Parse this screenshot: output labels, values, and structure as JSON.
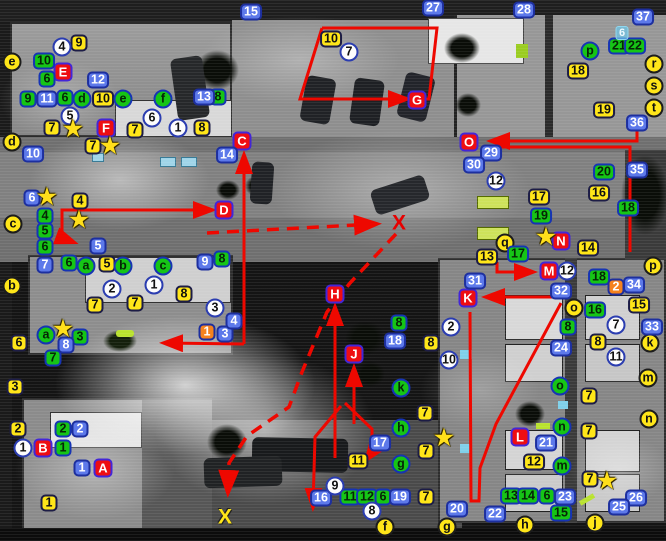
{
  "colors": {
    "route": "#ee0800",
    "site_red": "#ee0d12",
    "attacker_blue": "#5d79ea",
    "defender_green": "#16c516",
    "note_yellow": "#ffe619",
    "orange": "#f5821e"
  },
  "markers": [
    {
      "t": "red",
      "l": "A",
      "x": 103,
      "y": 468
    },
    {
      "t": "red",
      "l": "B",
      "x": 43,
      "y": 448
    },
    {
      "t": "red",
      "l": "C",
      "x": 242,
      "y": 141
    },
    {
      "t": "red",
      "l": "D",
      "x": 224,
      "y": 210
    },
    {
      "t": "red",
      "l": "E",
      "x": 63,
      "y": 72
    },
    {
      "t": "red",
      "l": "F",
      "x": 106,
      "y": 128
    },
    {
      "t": "red",
      "l": "G",
      "x": 417,
      "y": 100
    },
    {
      "t": "red",
      "l": "H",
      "x": 335,
      "y": 294
    },
    {
      "t": "red",
      "l": "J",
      "x": 354,
      "y": 354
    },
    {
      "t": "red",
      "l": "K",
      "x": 468,
      "y": 298
    },
    {
      "t": "red",
      "l": "L",
      "x": 520,
      "y": 437
    },
    {
      "t": "red",
      "l": "M",
      "x": 549,
      "y": 271
    },
    {
      "t": "red",
      "l": "N",
      "x": 561,
      "y": 241
    },
    {
      "t": "red",
      "l": "O",
      "x": 469,
      "y": 142
    },
    {
      "t": "ysq",
      "l": "9",
      "x": 79,
      "y": 43
    },
    {
      "t": "ysq",
      "l": "10",
      "x": 103,
      "y": 99
    },
    {
      "t": "ysq",
      "l": "7",
      "x": 52,
      "y": 128
    },
    {
      "t": "ysq",
      "l": "7",
      "x": 135,
      "y": 130
    },
    {
      "t": "ysq",
      "l": "8",
      "x": 202,
      "y": 128
    },
    {
      "t": "ysq",
      "l": "10",
      "x": 331,
      "y": 39
    },
    {
      "t": "ysq",
      "l": "18",
      "x": 578,
      "y": 71
    },
    {
      "t": "ysq",
      "l": "19",
      "x": 604,
      "y": 110
    },
    {
      "t": "ysq",
      "l": "7",
      "x": 93,
      "y": 146
    },
    {
      "t": "ysq",
      "l": "4",
      "x": 80,
      "y": 201
    },
    {
      "t": "ysq",
      "l": "17",
      "x": 539,
      "y": 197
    },
    {
      "t": "ysq",
      "l": "16",
      "x": 599,
      "y": 193
    },
    {
      "t": "ysq",
      "l": "14",
      "x": 588,
      "y": 248
    },
    {
      "t": "ysq",
      "l": "13",
      "x": 487,
      "y": 257
    },
    {
      "t": "ysq",
      "l": "5",
      "x": 107,
      "y": 264
    },
    {
      "t": "ysq",
      "l": "6",
      "x": 19,
      "y": 343
    },
    {
      "t": "ysq",
      "l": "3",
      "x": 15,
      "y": 387
    },
    {
      "t": "ysq",
      "l": "7",
      "x": 95,
      "y": 305
    },
    {
      "t": "ysq",
      "l": "7",
      "x": 135,
      "y": 303
    },
    {
      "t": "ysq",
      "l": "8",
      "x": 184,
      "y": 294
    },
    {
      "t": "ysq",
      "l": "2",
      "x": 18,
      "y": 429
    },
    {
      "t": "ysq",
      "l": "1",
      "x": 49,
      "y": 503
    },
    {
      "t": "ysq",
      "l": "8",
      "x": 431,
      "y": 343
    },
    {
      "t": "ysq",
      "l": "7",
      "x": 425,
      "y": 413
    },
    {
      "t": "ysq",
      "l": "7",
      "x": 426,
      "y": 451
    },
    {
      "t": "ysq",
      "l": "11",
      "x": 358,
      "y": 461
    },
    {
      "t": "ysq",
      "l": "7",
      "x": 426,
      "y": 497
    },
    {
      "t": "ysq",
      "l": "15",
      "x": 639,
      "y": 305
    },
    {
      "t": "ysq",
      "l": "8",
      "x": 598,
      "y": 342
    },
    {
      "t": "ysq",
      "l": "7",
      "x": 589,
      "y": 396
    },
    {
      "t": "ysq",
      "l": "7",
      "x": 589,
      "y": 431
    },
    {
      "t": "ysq",
      "l": "12",
      "x": 534,
      "y": 462
    },
    {
      "t": "ysq",
      "l": "7",
      "x": 590,
      "y": 479
    },
    {
      "t": "ycir",
      "l": "e",
      "x": 12,
      "y": 62
    },
    {
      "t": "ycir",
      "l": "d",
      "x": 12,
      "y": 142
    },
    {
      "t": "ycir",
      "l": "c",
      "x": 13,
      "y": 224
    },
    {
      "t": "ycir",
      "l": "b",
      "x": 12,
      "y": 286
    },
    {
      "t": "ycir",
      "l": "q",
      "x": 505,
      "y": 243
    },
    {
      "t": "ycir",
      "l": "p",
      "x": 653,
      "y": 266
    },
    {
      "t": "ycir",
      "l": "r",
      "x": 654,
      "y": 64
    },
    {
      "t": "ycir",
      "l": "s",
      "x": 654,
      "y": 86
    },
    {
      "t": "ycir",
      "l": "t",
      "x": 654,
      "y": 108
    },
    {
      "t": "ycir",
      "l": "k",
      "x": 650,
      "y": 343
    },
    {
      "t": "ycir",
      "l": "m",
      "x": 648,
      "y": 378
    },
    {
      "t": "ycir",
      "l": "n",
      "x": 649,
      "y": 419
    },
    {
      "t": "ycir",
      "l": "o",
      "x": 574,
      "y": 308
    },
    {
      "t": "ycir",
      "l": "f",
      "x": 385,
      "y": 527
    },
    {
      "t": "ycir",
      "l": "g",
      "x": 447,
      "y": 527
    },
    {
      "t": "ycir",
      "l": "h",
      "x": 525,
      "y": 525
    },
    {
      "t": "ycir",
      "l": "j",
      "x": 595,
      "y": 523
    },
    {
      "t": "gsq",
      "l": "10",
      "x": 44,
      "y": 61
    },
    {
      "t": "gsq",
      "l": "6",
      "x": 47,
      "y": 79
    },
    {
      "t": "gsq",
      "l": "9",
      "x": 28,
      "y": 99
    },
    {
      "t": "gsq",
      "l": "6",
      "x": 65,
      "y": 98
    },
    {
      "t": "gsq",
      "l": "8",
      "x": 218,
      "y": 97
    },
    {
      "t": "gsq",
      "l": "21",
      "x": 619,
      "y": 46
    },
    {
      "t": "gsq",
      "l": "22",
      "x": 635,
      "y": 46
    },
    {
      "t": "gsq",
      "l": "4",
      "x": 45,
      "y": 216
    },
    {
      "t": "gsq",
      "l": "5",
      "x": 45,
      "y": 231
    },
    {
      "t": "gsq",
      "l": "6",
      "x": 45,
      "y": 247
    },
    {
      "t": "gsq",
      "l": "6",
      "x": 69,
      "y": 263
    },
    {
      "t": "gsq",
      "l": "8",
      "x": 222,
      "y": 259
    },
    {
      "t": "gsq",
      "l": "3",
      "x": 80,
      "y": 337
    },
    {
      "t": "gsq",
      "l": "7",
      "x": 53,
      "y": 358
    },
    {
      "t": "gsq",
      "l": "2",
      "x": 63,
      "y": 429
    },
    {
      "t": "gsq",
      "l": "1",
      "x": 63,
      "y": 448
    },
    {
      "t": "gsq",
      "l": "20",
      "x": 604,
      "y": 172
    },
    {
      "t": "gsq",
      "l": "19",
      "x": 541,
      "y": 216
    },
    {
      "t": "gsq",
      "l": "18",
      "x": 628,
      "y": 208
    },
    {
      "t": "gsq",
      "l": "17",
      "x": 518,
      "y": 254
    },
    {
      "t": "gsq",
      "l": "18",
      "x": 599,
      "y": 277
    },
    {
      "t": "gsq",
      "l": "16",
      "x": 595,
      "y": 310
    },
    {
      "t": "gsq",
      "l": "8",
      "x": 568,
      "y": 327
    },
    {
      "t": "gsq",
      "l": "8",
      "x": 399,
      "y": 323
    },
    {
      "t": "gsq",
      "l": "11",
      "x": 350,
      "y": 497
    },
    {
      "t": "gsq",
      "l": "12",
      "x": 367,
      "y": 497
    },
    {
      "t": "gsq",
      "l": "6",
      "x": 383,
      "y": 497
    },
    {
      "t": "gsq",
      "l": "13",
      "x": 511,
      "y": 496
    },
    {
      "t": "gsq",
      "l": "14",
      "x": 528,
      "y": 496
    },
    {
      "t": "gsq",
      "l": "6",
      "x": 547,
      "y": 496
    },
    {
      "t": "gsq",
      "l": "15",
      "x": 561,
      "y": 513
    },
    {
      "t": "gcir",
      "l": "d",
      "x": 82,
      "y": 99
    },
    {
      "t": "gcir",
      "l": "e",
      "x": 123,
      "y": 99
    },
    {
      "t": "gcir",
      "l": "f",
      "x": 163,
      "y": 99
    },
    {
      "t": "gcir",
      "l": "a",
      "x": 86,
      "y": 266
    },
    {
      "t": "gcir",
      "l": "b",
      "x": 123,
      "y": 266
    },
    {
      "t": "gcir",
      "l": "c",
      "x": 163,
      "y": 266
    },
    {
      "t": "gcir",
      "l": "a",
      "x": 46,
      "y": 335
    },
    {
      "t": "gcir",
      "l": "g",
      "x": 401,
      "y": 464
    },
    {
      "t": "gcir",
      "l": "h",
      "x": 401,
      "y": 428
    },
    {
      "t": "gcir",
      "l": "k",
      "x": 401,
      "y": 388
    },
    {
      "t": "gcir",
      "l": "m",
      "x": 562,
      "y": 466
    },
    {
      "t": "gcir",
      "l": "n",
      "x": 562,
      "y": 427
    },
    {
      "t": "gcir",
      "l": "o",
      "x": 560,
      "y": 386
    },
    {
      "t": "gcir",
      "l": "p",
      "x": 590,
      "y": 51
    },
    {
      "t": "bsq",
      "l": "15",
      "x": 251,
      "y": 12
    },
    {
      "t": "bsq",
      "l": "27",
      "x": 433,
      "y": 8
    },
    {
      "t": "bsq",
      "l": "28",
      "x": 524,
      "y": 10
    },
    {
      "t": "bsq",
      "l": "37",
      "x": 643,
      "y": 17
    },
    {
      "t": "bsq",
      "l": "36",
      "x": 637,
      "y": 123
    },
    {
      "t": "bsq",
      "l": "35",
      "x": 637,
      "y": 170
    },
    {
      "t": "bsq",
      "l": "12",
      "x": 98,
      "y": 80
    },
    {
      "t": "bsq",
      "l": "11",
      "x": 47,
      "y": 99
    },
    {
      "t": "bsq",
      "l": "13",
      "x": 204,
      "y": 97
    },
    {
      "t": "bsq",
      "l": "14",
      "x": 227,
      "y": 155
    },
    {
      "t": "bsq",
      "l": "10",
      "x": 33,
      "y": 154
    },
    {
      "t": "bsq",
      "l": "6",
      "x": 32,
      "y": 198
    },
    {
      "t": "bsq",
      "l": "5",
      "x": 98,
      "y": 246
    },
    {
      "t": "bsq",
      "l": "7",
      "x": 45,
      "y": 265
    },
    {
      "t": "bsq",
      "l": "9",
      "x": 205,
      "y": 262
    },
    {
      "t": "bsq",
      "l": "29",
      "x": 491,
      "y": 153
    },
    {
      "t": "bsq",
      "l": "30",
      "x": 474,
      "y": 165
    },
    {
      "t": "bsq",
      "l": "31",
      "x": 475,
      "y": 281
    },
    {
      "t": "bsq",
      "l": "32",
      "x": 561,
      "y": 291
    },
    {
      "t": "bsq",
      "l": "24",
      "x": 561,
      "y": 348
    },
    {
      "t": "bsq",
      "l": "33",
      "x": 652,
      "y": 327
    },
    {
      "t": "bsq",
      "l": "34",
      "x": 634,
      "y": 285
    },
    {
      "t": "bsq",
      "l": "8",
      "x": 66,
      "y": 345
    },
    {
      "t": "bsq",
      "l": "3",
      "x": 225,
      "y": 334
    },
    {
      "t": "bsq",
      "l": "4",
      "x": 234,
      "y": 321
    },
    {
      "t": "bsq",
      "l": "17",
      "x": 380,
      "y": 443
    },
    {
      "t": "bsq",
      "l": "16",
      "x": 321,
      "y": 498
    },
    {
      "t": "bsq",
      "l": "19",
      "x": 400,
      "y": 497
    },
    {
      "t": "bsq",
      "l": "18",
      "x": 395,
      "y": 341
    },
    {
      "t": "bsq",
      "l": "23",
      "x": 565,
      "y": 497
    },
    {
      "t": "bsq",
      "l": "26",
      "x": 636,
      "y": 498
    },
    {
      "t": "bsq",
      "l": "25",
      "x": 619,
      "y": 507
    },
    {
      "t": "bsq",
      "l": "20",
      "x": 457,
      "y": 509
    },
    {
      "t": "bsq",
      "l": "22",
      "x": 495,
      "y": 514
    },
    {
      "t": "bsq",
      "l": "21",
      "x": 546,
      "y": 443
    },
    {
      "t": "bsq",
      "l": "1",
      "x": 82,
      "y": 468
    },
    {
      "t": "bsq",
      "l": "2",
      "x": 80,
      "y": 429
    },
    {
      "t": "wcir",
      "l": "4",
      "x": 62,
      "y": 47
    },
    {
      "t": "wcir",
      "l": "7",
      "x": 349,
      "y": 52
    },
    {
      "t": "wcir",
      "l": "5",
      "x": 70,
      "y": 116
    },
    {
      "t": "wcir",
      "l": "6",
      "x": 152,
      "y": 118
    },
    {
      "t": "wcir",
      "l": "1",
      "x": 178,
      "y": 128
    },
    {
      "t": "wcir",
      "l": "12",
      "x": 496,
      "y": 181
    },
    {
      "t": "wcir",
      "l": "12",
      "x": 567,
      "y": 271
    },
    {
      "t": "wcir",
      "l": "2",
      "x": 112,
      "y": 289
    },
    {
      "t": "wcir",
      "l": "1",
      "x": 154,
      "y": 285
    },
    {
      "t": "wcir",
      "l": "3",
      "x": 215,
      "y": 308
    },
    {
      "t": "wcir",
      "l": "2",
      "x": 451,
      "y": 327
    },
    {
      "t": "wcir",
      "l": "10",
      "x": 449,
      "y": 360
    },
    {
      "t": "wcir",
      "l": "7",
      "x": 616,
      "y": 325
    },
    {
      "t": "wcir",
      "l": "11",
      "x": 616,
      "y": 357
    },
    {
      "t": "wcir",
      "l": "9",
      "x": 335,
      "y": 486
    },
    {
      "t": "wcir",
      "l": "8",
      "x": 372,
      "y": 511
    },
    {
      "t": "wcir",
      "l": "1",
      "x": 23,
      "y": 448
    },
    {
      "t": "osq",
      "l": "1",
      "x": 207,
      "y": 332
    },
    {
      "t": "osq",
      "l": "2",
      "x": 616,
      "y": 287
    },
    {
      "t": "csq",
      "l": "6",
      "x": 622,
      "y": 33
    },
    {
      "t": "star",
      "l": "star",
      "x": 73,
      "y": 129
    },
    {
      "t": "star",
      "l": "star",
      "x": 110,
      "y": 146
    },
    {
      "t": "star",
      "l": "star",
      "x": 47,
      "y": 197
    },
    {
      "t": "star",
      "l": "star",
      "x": 79,
      "y": 220
    },
    {
      "t": "star",
      "l": "star",
      "x": 63,
      "y": 329
    },
    {
      "t": "star",
      "l": "star",
      "x": 546,
      "y": 237
    },
    {
      "t": "star",
      "l": "star",
      "x": 607,
      "y": 481
    },
    {
      "t": "star",
      "l": "star",
      "x": 444,
      "y": 438
    },
    {
      "t": "xr",
      "l": "X",
      "x": 399,
      "y": 223
    },
    {
      "t": "xy",
      "l": "X",
      "x": 225,
      "y": 517
    }
  ],
  "routes": [
    {
      "points": "322,28 437,28 429,99 300,99 322,28",
      "style": "solid",
      "arrow": false
    },
    {
      "points": "390,99 406,99",
      "style": "solid",
      "arrow": true
    },
    {
      "points": "637,125 637,141 492,141",
      "style": "solid",
      "arrow": true
    },
    {
      "points": "497,147 630,147 630,252",
      "style": "solid",
      "arrow": false
    },
    {
      "points": "62,242 62,210 211,210",
      "style": "solid",
      "arrow": true
    },
    {
      "points": "62,238 73,242",
      "style": "solid",
      "arrow": true
    },
    {
      "points": "244,344 244,156",
      "style": "solid",
      "arrow": true
    },
    {
      "points": "244,344 165,343",
      "style": "solid",
      "arrow": true
    },
    {
      "points": "335,458 335,308",
      "style": "solid",
      "arrow": true
    },
    {
      "points": "354,424 354,369",
      "style": "solid",
      "arrow": true
    },
    {
      "points": "345,403 372,429 372,452 367,459",
      "style": "solid",
      "arrow": true
    },
    {
      "points": "341,406 315,437 313,506",
      "style": "solid",
      "arrow": true
    },
    {
      "points": "553,297 487,297",
      "style": "solid",
      "arrow": true
    },
    {
      "points": "561,303 496,424 480,468 479,501 471,501 470,312",
      "style": "solid",
      "arrow": false
    },
    {
      "points": "497,262 497,272 532,272",
      "style": "solid",
      "arrow": true
    },
    {
      "points": "207,233 375,224",
      "style": "dashed",
      "arrow": true
    },
    {
      "points": "396,234 350,283 327,312 302,372 289,407 247,436 229,463 228,491",
      "style": "dashed",
      "arrow": true
    }
  ]
}
